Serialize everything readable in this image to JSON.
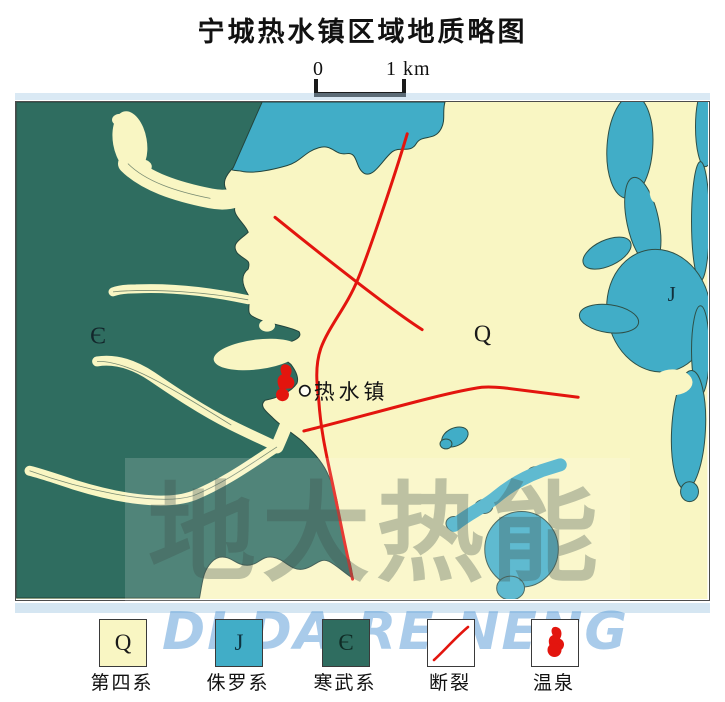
{
  "title": "宁城热水镇区域地质略图",
  "scale_bar": {
    "start": "0",
    "end": "1 km"
  },
  "map": {
    "labels": {
      "cambrian": "Є",
      "quaternary": "Q",
      "jurassic": "J",
      "town": "热水镇"
    }
  },
  "legend": {
    "items": [
      {
        "symbol": "Q",
        "label": "第四系"
      },
      {
        "symbol": "J",
        "label": "侏罗系"
      },
      {
        "symbol": "Є",
        "label": "寒武系"
      },
      {
        "symbol": "",
        "label": "断裂"
      },
      {
        "symbol": "",
        "label": "温泉"
      }
    ]
  },
  "watermark": {
    "cn": "地大热能",
    "en": "DI DA RE NENG"
  },
  "colors": {
    "quaternary": "#f9f6c3",
    "jurassic": "#41adc7",
    "cambrian": "#2f6d60",
    "fault": "#e3150e"
  }
}
